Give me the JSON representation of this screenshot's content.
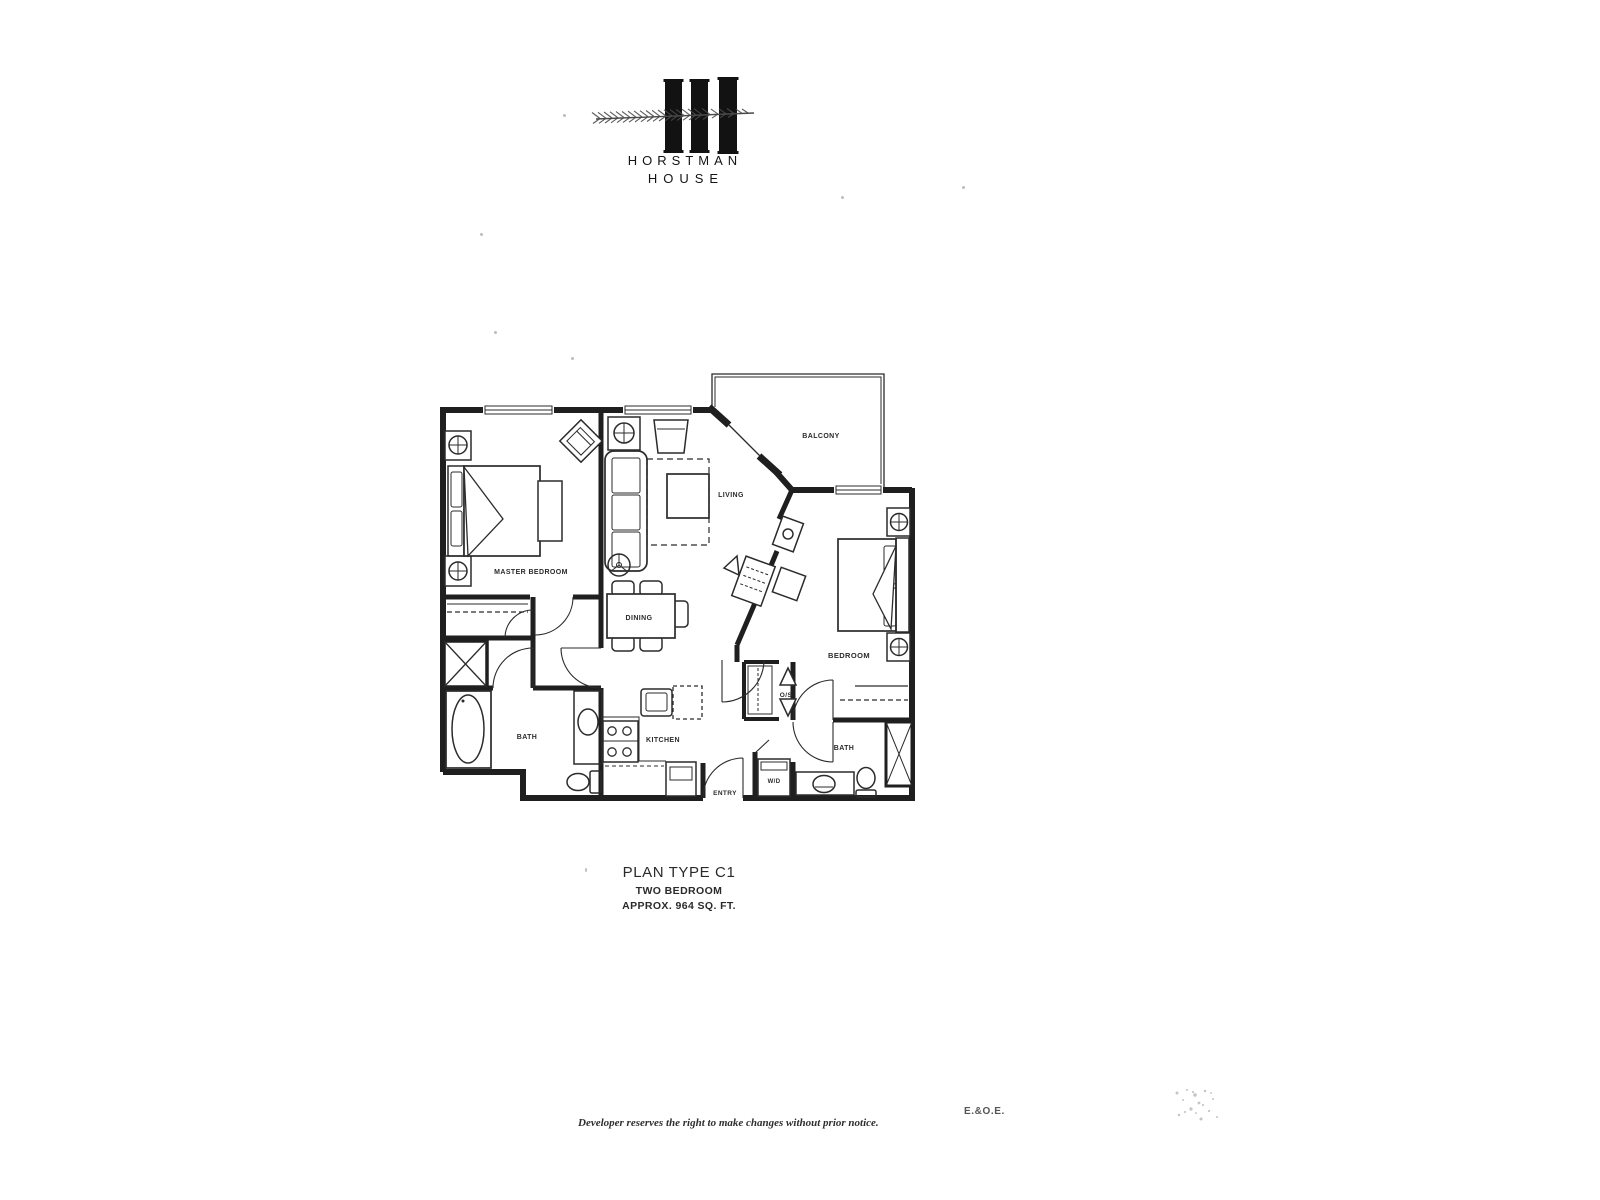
{
  "logo": {
    "name_line1": "HORSTMAN",
    "name_line2": "HOUSE",
    "mark": "three-bars-with-conifer-branch"
  },
  "plan": {
    "labels": {
      "master_bedroom": "MASTER BEDROOM",
      "living": "LIVING",
      "balcony": "BALCONY",
      "dining": "DINING",
      "bedroom": "BEDROOM",
      "kitchen": "KITCHEN",
      "bath_master": "BATH",
      "bath_second": "BATH",
      "entry": "ENTRY",
      "washer_dryer": "W/D",
      "storage": "O/S"
    },
    "title": {
      "line1": "PLAN TYPE C1",
      "line2": "TWO BEDROOM",
      "line3": "APPROX. 964 SQ. FT."
    }
  },
  "footer": {
    "disclaimer": "Developer reserves the right to make changes without prior notice.",
    "eoe": "E.&O.E."
  },
  "colors": {
    "ink": "#1f1f1f",
    "paper": "#ffffff"
  }
}
